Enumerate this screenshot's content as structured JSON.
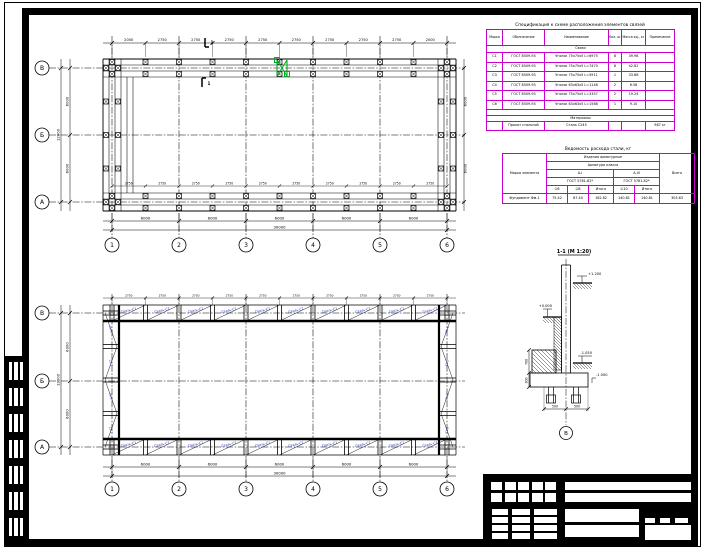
{
  "colors": {
    "line": "#000000",
    "table_border": "#cc00cc",
    "brace_text": "#2233bb",
    "highlight": "#00aa22"
  },
  "plan_top": {
    "letters": [
      "В",
      "Б",
      "А"
    ],
    "numbers": [
      "1",
      "2",
      "3",
      "4",
      "5",
      "6"
    ],
    "top_dims": [
      "2000",
      "2750",
      "2750",
      "2750",
      "2750",
      "2750",
      "2750",
      "2750",
      "2750",
      "2000"
    ],
    "inner_dims": [
      "2750",
      "2750",
      "2750",
      "2750",
      "2750",
      "2750",
      "2750",
      "2750",
      "2750",
      "2750"
    ],
    "bay_dims": [
      "6000",
      "6000",
      "6000",
      "6000",
      "6000"
    ],
    "total_dim": "30000",
    "side_dims": [
      "6000",
      "6000"
    ],
    "side_total": "12000",
    "section_mark": "1"
  },
  "plan_bottom": {
    "letters": [
      "В",
      "Б",
      "А"
    ],
    "numbers": [
      "1",
      "2",
      "3",
      "4",
      "5",
      "6"
    ],
    "post_dims": [
      "2750",
      "2750",
      "2750",
      "2750",
      "2750",
      "2750",
      "2750",
      "2750",
      "2750",
      "2750"
    ],
    "bay_dims": [
      "6000",
      "6000",
      "6000",
      "6000",
      "6000"
    ],
    "total_dim": "30000",
    "side_dims": [
      "6000",
      "6000"
    ],
    "side_total": "12000",
    "brace_label": "Связь-С1",
    "side_brace_label": "Св-2"
  },
  "spec_table": {
    "title": "Спецификация к схеме расположения элементов связей",
    "headers": [
      "Марка",
      "Обозначение",
      "Наименование",
      "Кол. шт.",
      "Масса ед., кг",
      "Примечание"
    ],
    "group1": "Связи",
    "rows": [
      [
        "С1",
        "ГОСТ 8509-93",
        "Уголок 75х75х5 L=6975",
        "8",
        "39.98",
        ""
      ],
      [
        "С2",
        "ГОСТ 8509-93",
        "Уголок 75х75х5 L=7470",
        "8",
        "42.82",
        ""
      ],
      [
        "С3",
        "ГОСТ 8509-93",
        "Уголок 75х75х5 L=5911",
        "1",
        "33.88",
        ""
      ],
      [
        "С4",
        "ГОСТ 8509-93",
        "Уголок 63х63х5 L=1148",
        "2",
        "6.58",
        ""
      ],
      [
        "С5",
        "ГОСТ 8509-93",
        "Уголок 75х75х5 L=3357",
        "2",
        "19.24",
        ""
      ],
      [
        "С6",
        "ГОСТ 8509-93",
        "Уголок 63х63х5 L=1588",
        "1",
        "9.10",
        ""
      ]
    ],
    "group2": "Материалы",
    "footer": [
      "",
      "Прокат стальной",
      "Сталь С245",
      "",
      "",
      "987 кг"
    ]
  },
  "steel_table": {
    "title": "Ведомость расхода стали, кг",
    "left_header": "Марка элемента",
    "span1": "Изделия арматурные",
    "span2": "Арматура класса",
    "group1": "А-I",
    "gost1": "ГОСТ 5781-82*",
    "group2": "А-III",
    "gost2": "ГОСТ 5781-82*",
    "cols": [
      "∅6",
      "∅8",
      "Итого",
      "∅10",
      "Итого"
    ],
    "total_header": "Всего",
    "row": [
      "Фундамент Фм-1",
      "75.42",
      "87.40",
      "162.82",
      "140.81",
      "140.81",
      "303.63"
    ]
  },
  "detail": {
    "title": "1-1 (М 1:20)",
    "level_top": "+1.200",
    "level_zero": "+0.000",
    "level_mid": "-1.050",
    "level_low": "-1.500",
    "dim_left1": "700",
    "dim_left2": "300",
    "dim_bolt1": "500",
    "dim_bolt2": "500",
    "axis_bubble": "В"
  }
}
